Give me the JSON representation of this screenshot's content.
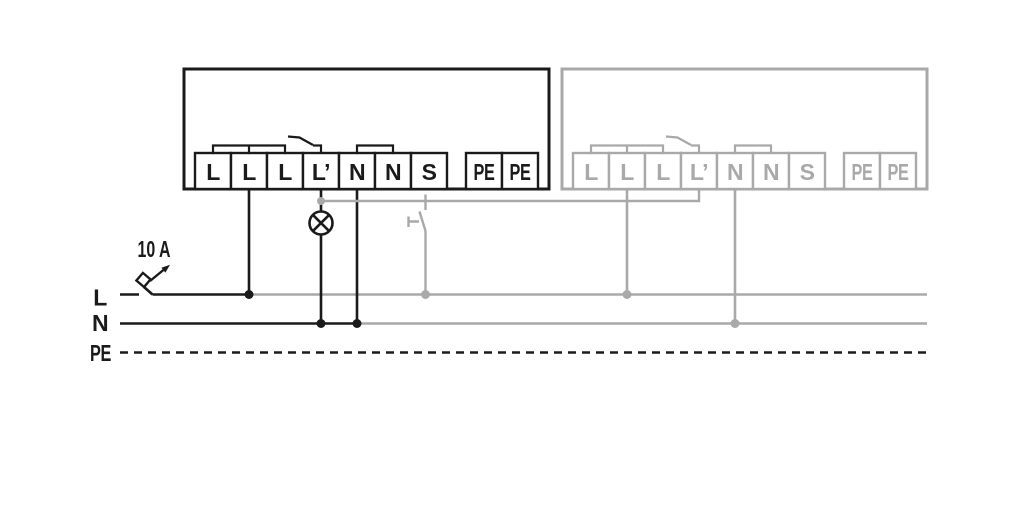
{
  "breaker": {
    "label": "10 A"
  },
  "bus": {
    "l_label": "L",
    "n_label": "N",
    "pe_label": "PE"
  },
  "devices": [
    {
      "id": "device-active",
      "state": "active",
      "terminals": [
        "L",
        "L",
        "L",
        "L’",
        "N",
        "N",
        "S",
        "PE",
        "PE"
      ]
    },
    {
      "id": "device-inactive",
      "state": "inactive",
      "terminals": [
        "L",
        "L",
        "L",
        "L’",
        "N",
        "N",
        "S",
        "PE",
        "PE"
      ]
    }
  ],
  "colors": {
    "active": "#1a1a1a",
    "inactive": "#a9a9a9",
    "background": "#ffffff"
  }
}
